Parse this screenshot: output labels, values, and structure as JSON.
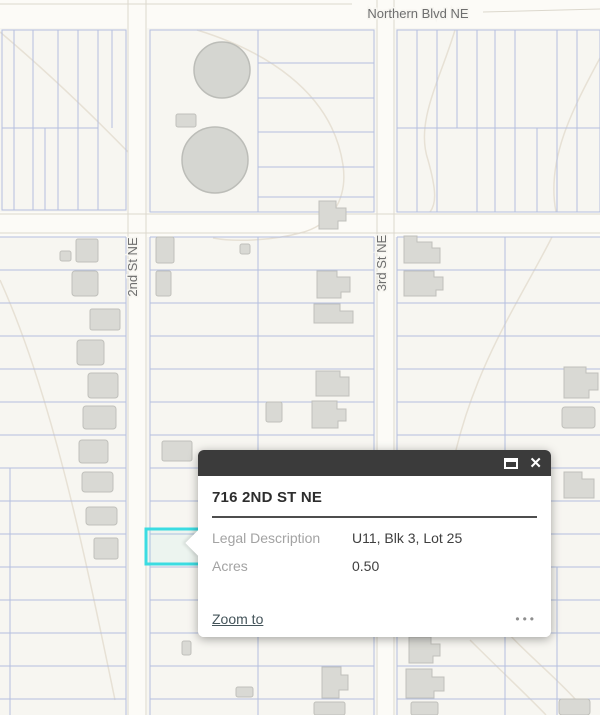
{
  "map": {
    "street_labels": {
      "northern_blvd": "Northern Blvd NE",
      "second_st": "2nd St NE",
      "third_st": "3rd St NE"
    },
    "colors": {
      "map_background": "#f7f6f1",
      "street_fill": "#fcfbf7",
      "parcel_line": "#b4bfe0",
      "building_fill": "#d9d9d4",
      "contour_line": "#e7e1d5",
      "selection_highlight": "#3bdce2",
      "popup_header": "#3b3b3b"
    }
  },
  "popup": {
    "title": "716 2ND ST NE",
    "fields": [
      {
        "label": "Legal Description",
        "value": "U11, Blk 3, Lot 25"
      },
      {
        "label": "Acres",
        "value": "0.50"
      }
    ],
    "actions": {
      "zoom_to": "Zoom to",
      "more_options": "•••"
    },
    "window_controls": {
      "close": "✕"
    }
  }
}
